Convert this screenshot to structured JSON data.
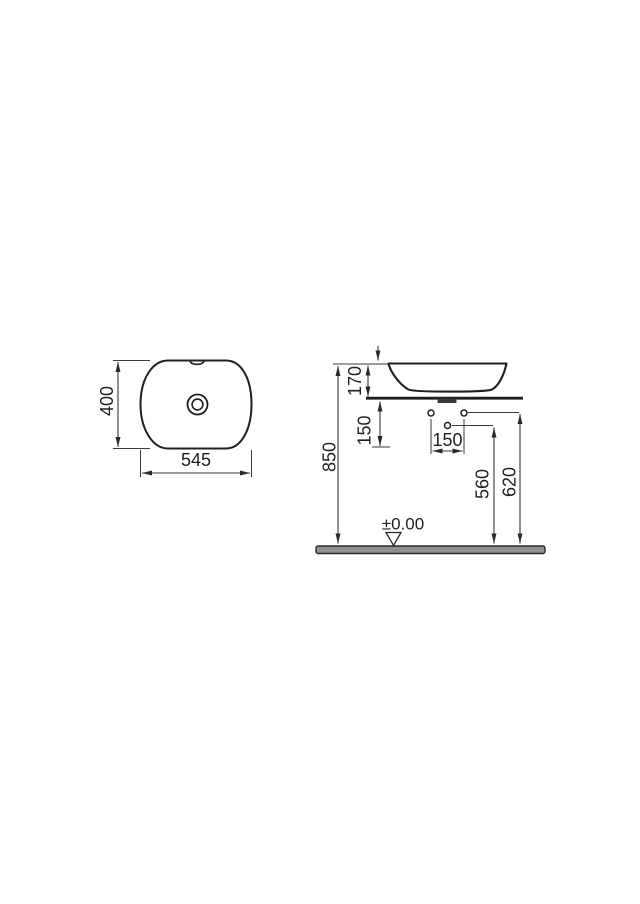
{
  "drawing": {
    "title": "countertop-basin-technical-drawing",
    "top_view": {
      "depth_dim": "400",
      "width_dim": "545"
    },
    "side_view": {
      "rim_height_dim": "170",
      "counter_height_dim": "850",
      "below_counter_dim": "150",
      "hole_spacing_dim": "150",
      "mid_hole_height_dim": "560",
      "side_hole_height_dim": "620",
      "floor_datum": "±0.00"
    },
    "colors": {
      "outline": "#1f1f1f",
      "dimension_line": "#3a3a3a",
      "floor_fill": "#8f8f8f",
      "background": "#ffffff"
    }
  }
}
